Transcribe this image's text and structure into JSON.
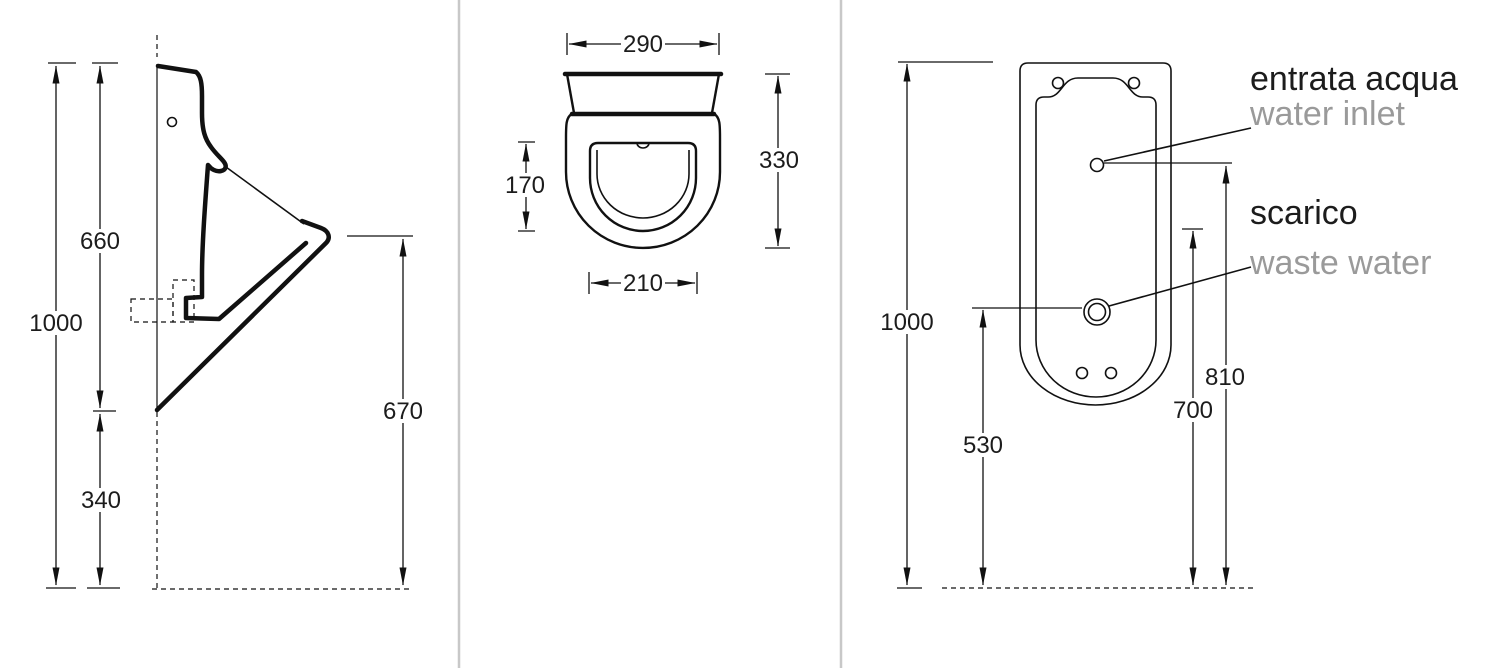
{
  "side_view": {
    "dims": {
      "overall_height": "1000",
      "upper_height": "660",
      "lower_height": "340",
      "lip_height": "670"
    }
  },
  "top_view": {
    "dims": {
      "top_width": "290",
      "bowl_depth": "170",
      "total_depth": "330",
      "bowl_width": "210"
    }
  },
  "rear_view": {
    "dims": {
      "overall_height": "1000",
      "waste_height": "530",
      "mid_height": "700",
      "inlet_height": "810"
    },
    "labels": {
      "inlet_it": "entrata acqua",
      "inlet_en": "water inlet",
      "waste_it": "scarico",
      "waste_en": "waste water"
    }
  },
  "colors": {
    "line": "#111111",
    "secondary_text": "#9a9a9a",
    "divider": "#c8c8c8"
  }
}
